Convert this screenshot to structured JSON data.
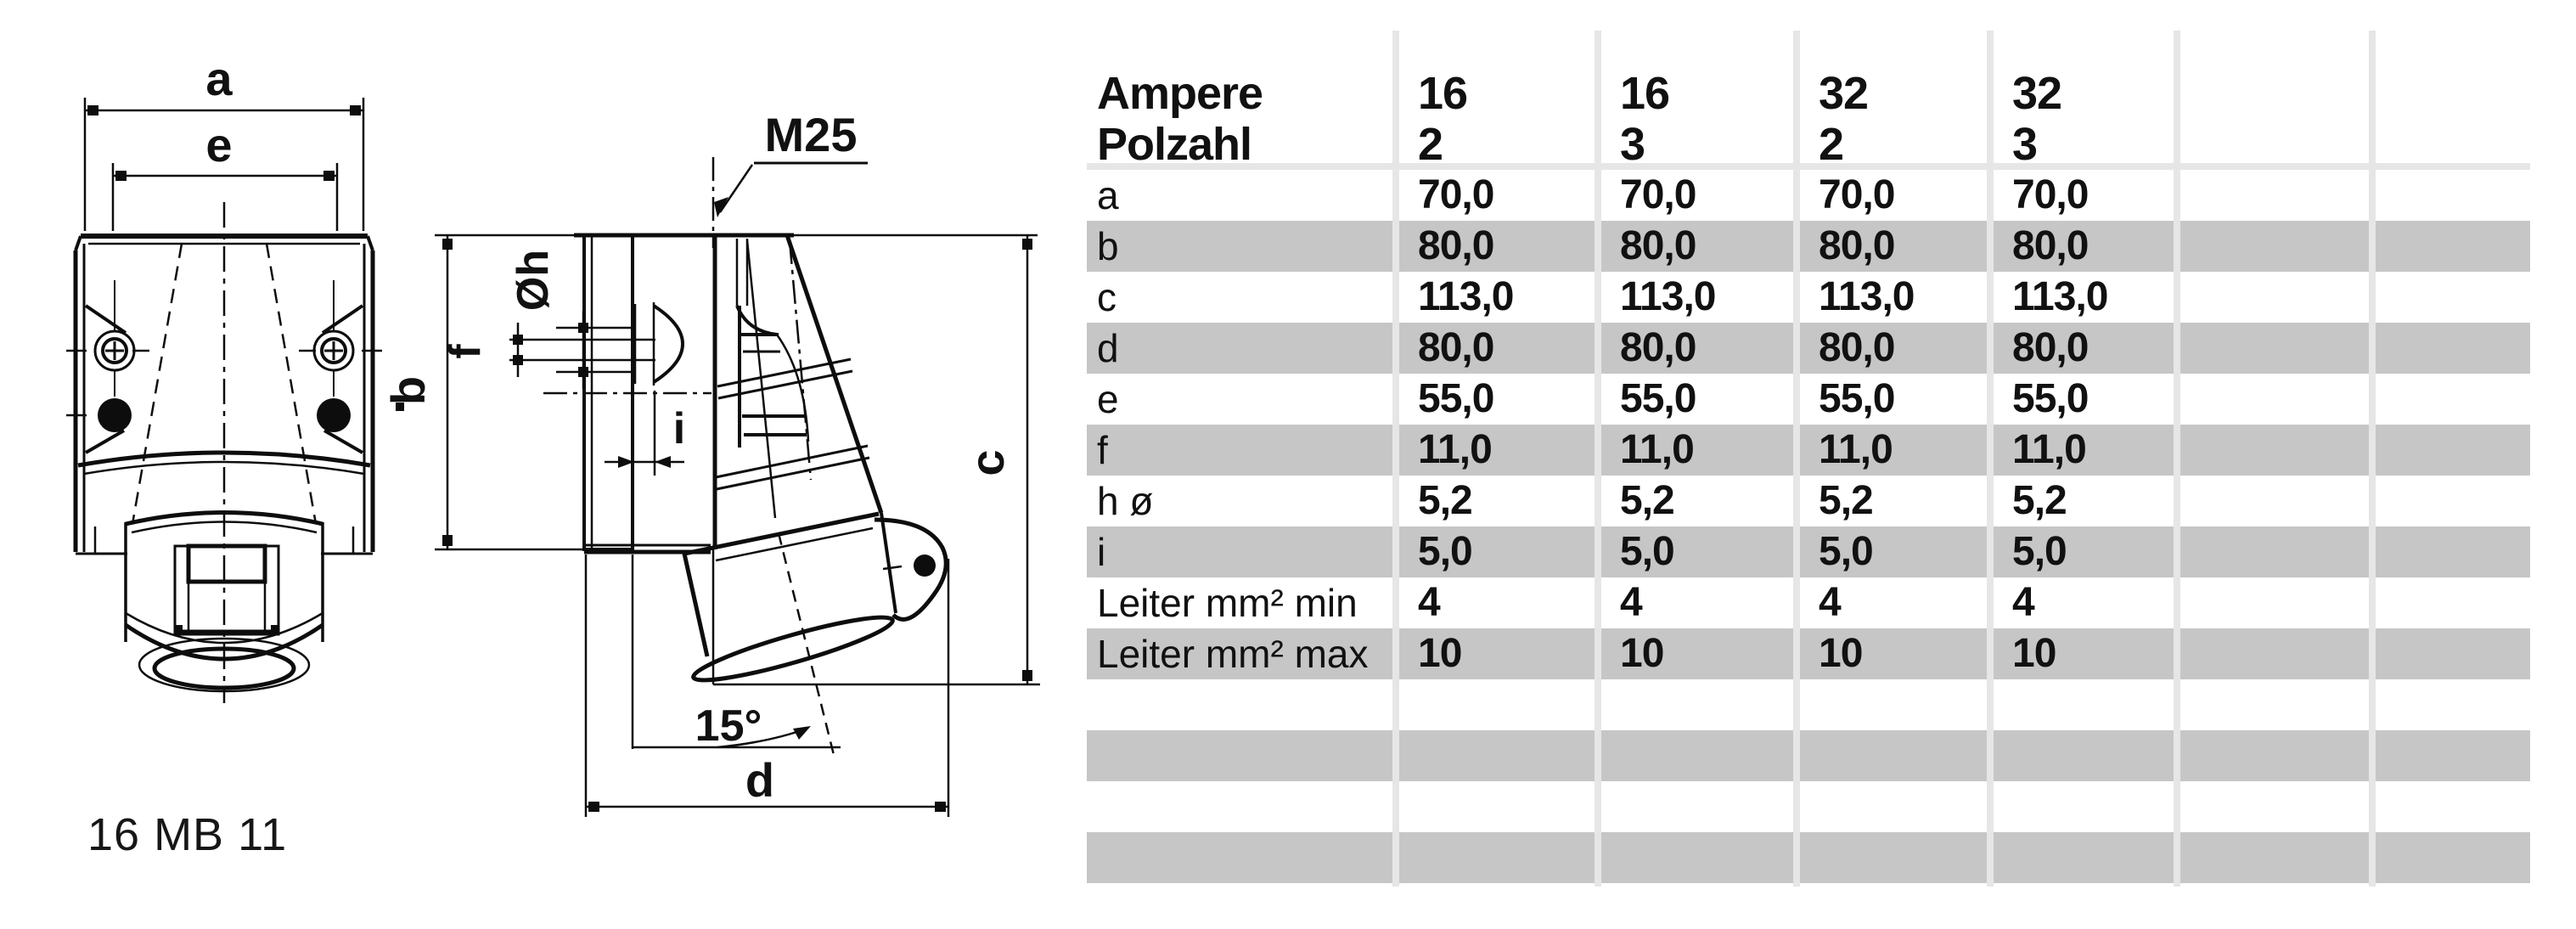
{
  "drawing": {
    "model_number": "16 MB 11",
    "labels": {
      "width_a": "a",
      "width_e": "e",
      "height_b": "b",
      "height_c": "c",
      "depth_d": "d",
      "offset_f": "f",
      "gap_i": "i",
      "hole_dia": "Øh",
      "gland_thread": "M25",
      "tilt_angle": "15°"
    }
  },
  "table": {
    "header": {
      "label_line1": "Ampere",
      "label_line2": "Polzahl",
      "columns": [
        {
          "line1": "16",
          "line2": "2"
        },
        {
          "line1": "16",
          "line2": "3"
        },
        {
          "line1": "32",
          "line2": "2"
        },
        {
          "line1": "32",
          "line2": "3"
        },
        {
          "line1": "",
          "line2": ""
        },
        {
          "line1": "",
          "line2": ""
        }
      ]
    },
    "rows": [
      {
        "label": "a",
        "values": [
          "70,0",
          "70,0",
          "70,0",
          "70,0"
        ],
        "shaded": false
      },
      {
        "label": "b",
        "values": [
          "80,0",
          "80,0",
          "80,0",
          "80,0"
        ],
        "shaded": true
      },
      {
        "label": "c",
        "values": [
          "113,0",
          "113,0",
          "113,0",
          "113,0"
        ],
        "shaded": false
      },
      {
        "label": "d",
        "values": [
          "80,0",
          "80,0",
          "80,0",
          "80,0"
        ],
        "shaded": true
      },
      {
        "label": "e",
        "values": [
          "55,0",
          "55,0",
          "55,0",
          "55,0"
        ],
        "shaded": false
      },
      {
        "label": "f",
        "values": [
          "11,0",
          "11,0",
          "11,0",
          "11,0"
        ],
        "shaded": true
      },
      {
        "label": "h ø",
        "values": [
          "5,2",
          "5,2",
          "5,2",
          "5,2"
        ],
        "shaded": false
      },
      {
        "label": "i",
        "values": [
          "5,0",
          "5,0",
          "5,0",
          "5,0"
        ],
        "shaded": true
      },
      {
        "label": "Leiter mm² min",
        "values": [
          "4",
          "4",
          "4",
          "4"
        ],
        "shaded": false
      },
      {
        "label": "Leiter mm² max",
        "values": [
          "10",
          "10",
          "10",
          "10"
        ],
        "shaded": true
      },
      {
        "label": "",
        "values": [
          "",
          "",
          "",
          ""
        ],
        "shaded": false
      },
      {
        "label": "",
        "values": [
          "",
          "",
          "",
          ""
        ],
        "shaded": true
      },
      {
        "label": "",
        "values": [
          "",
          "",
          "",
          ""
        ],
        "shaded": false
      },
      {
        "label": "",
        "values": [
          "",
          "",
          "",
          ""
        ],
        "shaded": true
      }
    ],
    "colors": {
      "shaded_row": "#c6c6c6",
      "separator": "#e6e6e6",
      "header_underline": "#e6e6e6",
      "text": "#111111",
      "line": "#0d0d0d"
    }
  }
}
